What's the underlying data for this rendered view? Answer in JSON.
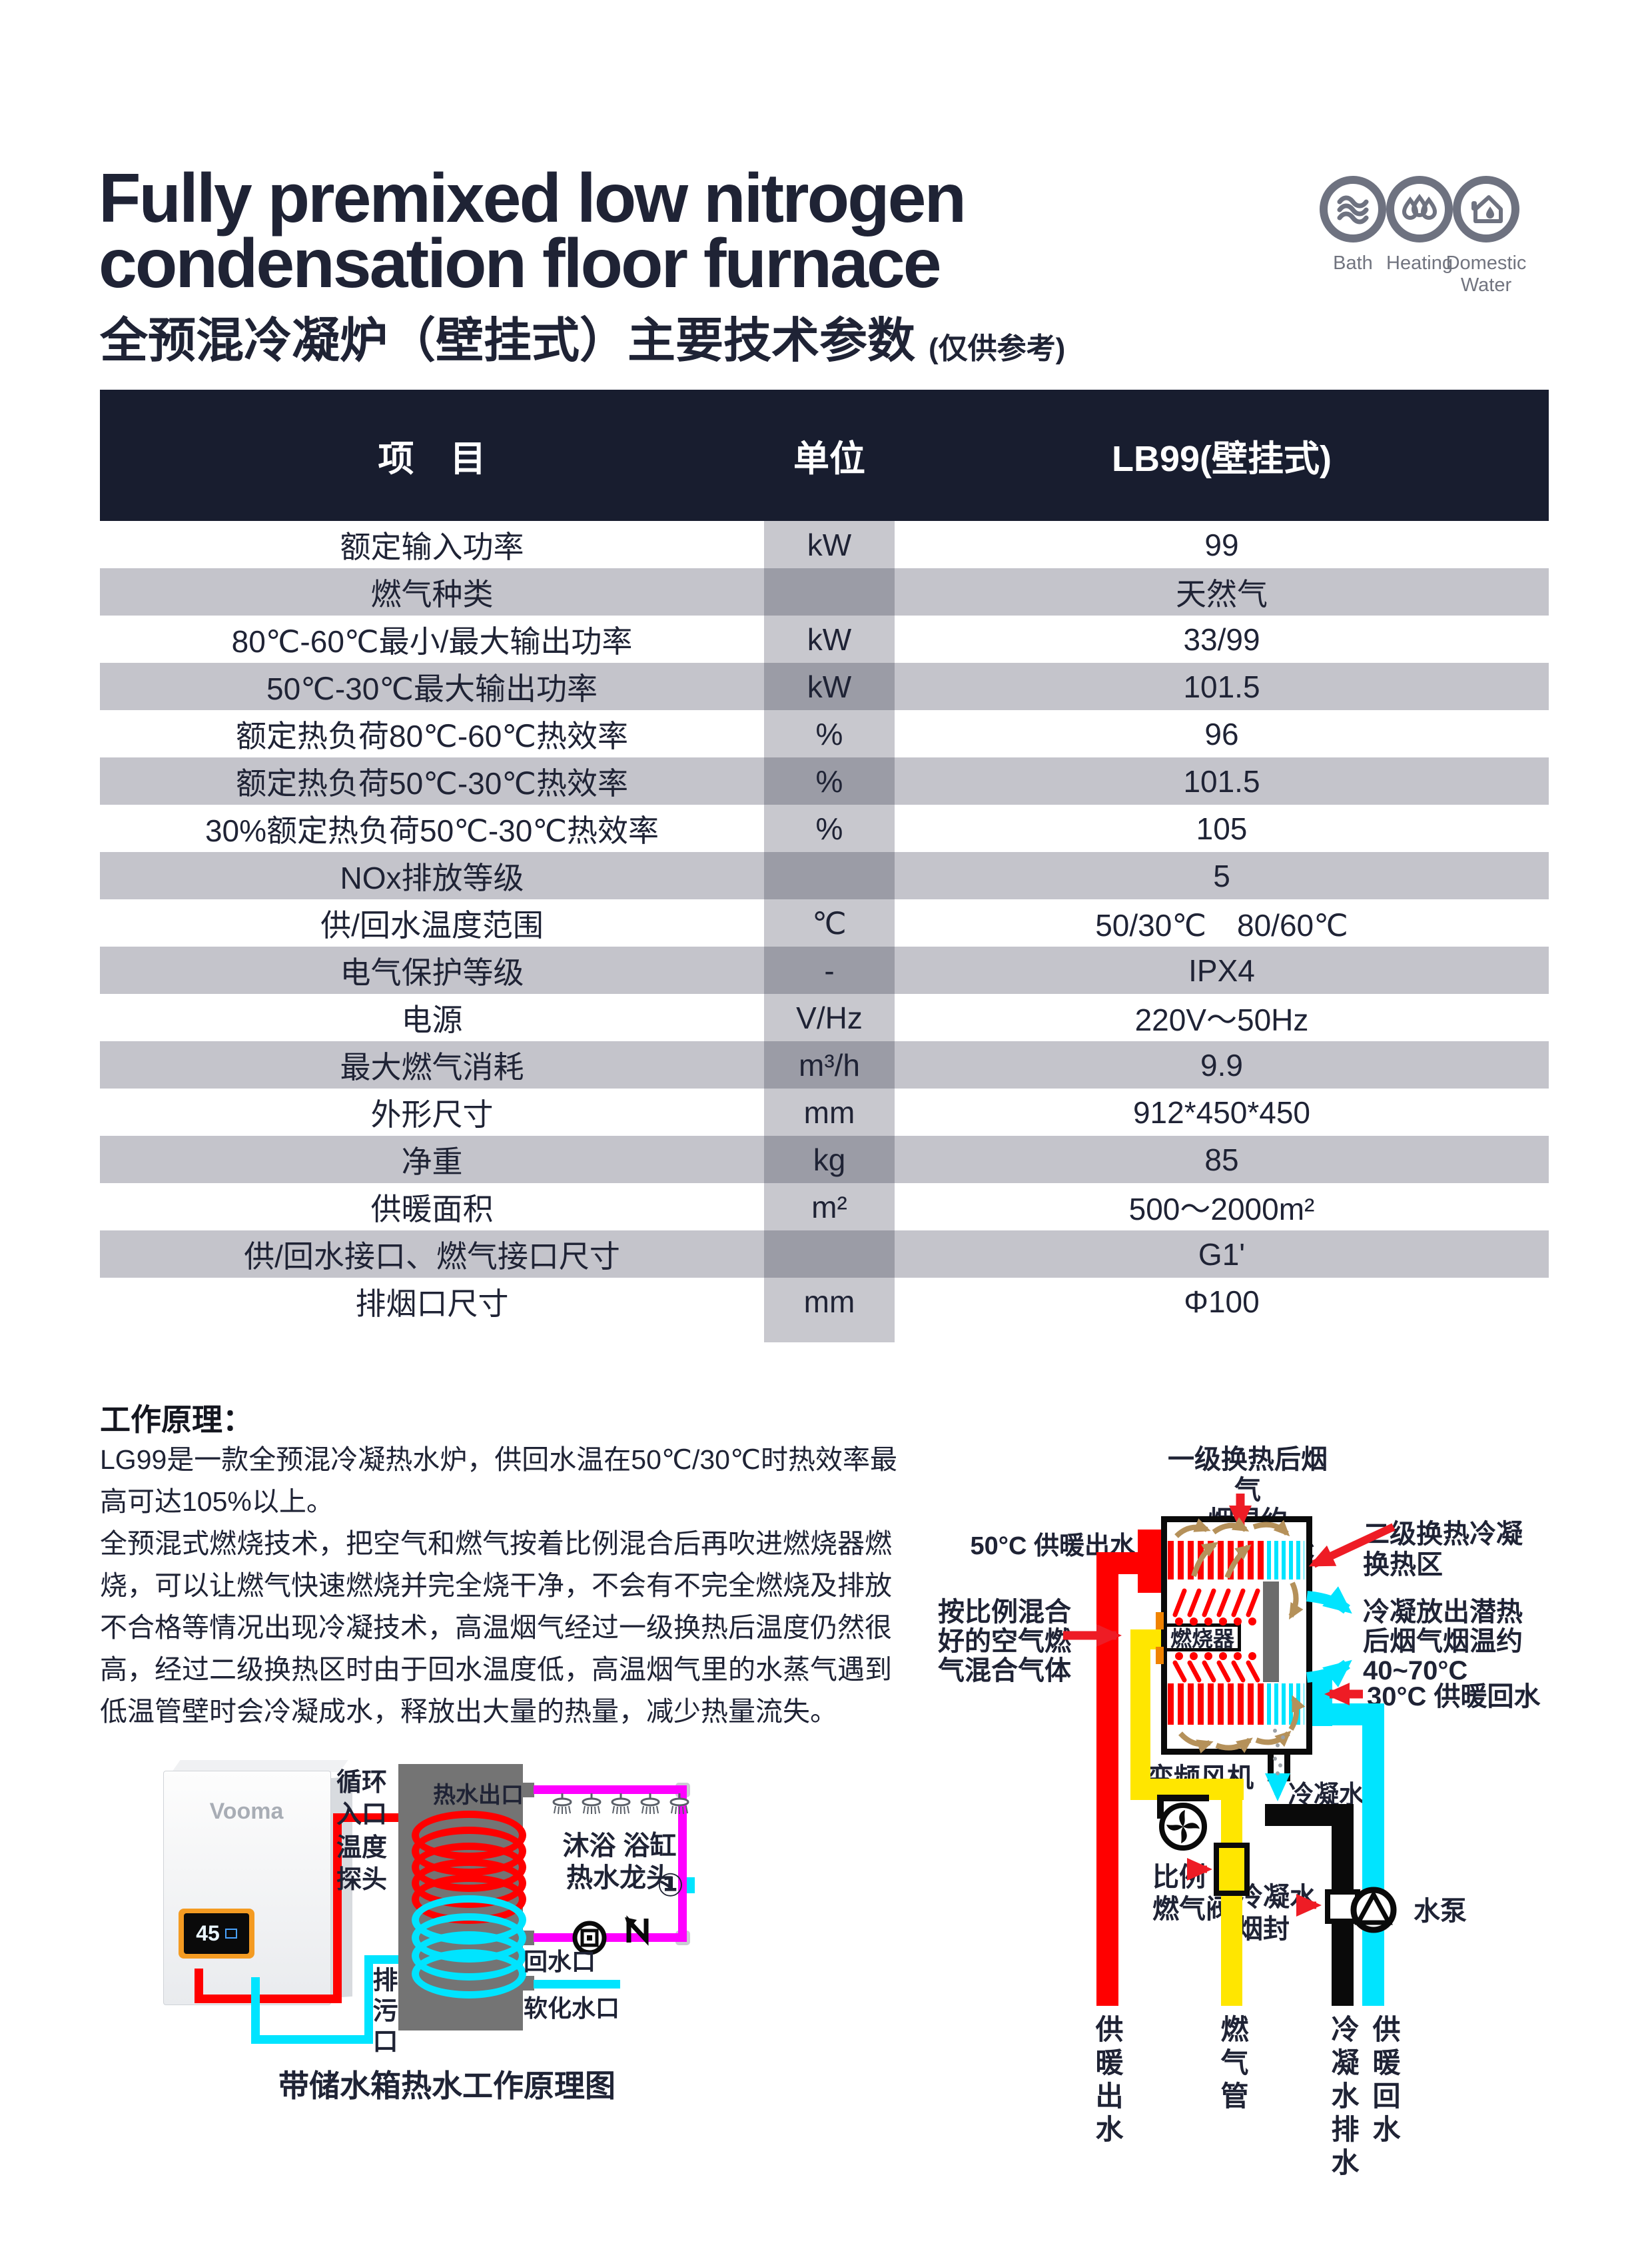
{
  "header": {
    "title_en_line1": "Fully premixed low nitrogen",
    "title_en_line2": "condensation floor furnace",
    "title_zh": "全预混冷凝炉（壁挂式）主要技术参数",
    "title_note": "(仅供参考)",
    "badges": [
      {
        "icon": "waves-icon",
        "label": "Bath"
      },
      {
        "icon": "drops-icon",
        "label": "Heating"
      },
      {
        "icon": "house-water-icon",
        "label_line1": "Domestic",
        "label_line2": "Water"
      }
    ]
  },
  "spec_table": {
    "columns": [
      "项　目",
      "单位",
      "LB99(壁挂式)"
    ],
    "rows": [
      {
        "item": "额定输入功率",
        "unit": "kW",
        "value": "99"
      },
      {
        "item": "燃气种类",
        "unit": "",
        "value": "天然气"
      },
      {
        "item": "80℃-60℃最小/最大输出功率",
        "unit": "kW",
        "value": "33/99"
      },
      {
        "item": "50℃-30℃最大输出功率",
        "unit": "kW",
        "value": "101.5"
      },
      {
        "item": "额定热负荷80℃-60℃热效率",
        "unit": "%",
        "value": "96"
      },
      {
        "item": "额定热负荷50℃-30℃热效率",
        "unit": "%",
        "value": "101.5"
      },
      {
        "item": "30%额定热负荷50℃-30℃热效率",
        "unit": "%",
        "value": "105"
      },
      {
        "item": "NOx排放等级",
        "unit": "",
        "value": "5"
      },
      {
        "item": "供/回水温度范围",
        "unit": "℃",
        "value": "50/30℃　80/60℃"
      },
      {
        "item": "电气保护等级",
        "unit": "-",
        "value": "IPX4"
      },
      {
        "item": "电源",
        "unit": "V/Hz",
        "value": "220V～50Hz"
      },
      {
        "item": "最大燃气消耗",
        "unit": "m³/h",
        "value": "9.9"
      },
      {
        "item": "外形尺寸",
        "unit": "mm",
        "value": "912*450*450"
      },
      {
        "item": "净重",
        "unit": "kg",
        "value": "85"
      },
      {
        "item": "供暖面积",
        "unit": "m²",
        "value": "500～2000m²"
      },
      {
        "item": "供/回水接口、燃气接口尺寸",
        "unit": "",
        "value": "G1'"
      },
      {
        "item": "排烟口尺寸",
        "unit": "mm",
        "value": "Φ100"
      }
    ]
  },
  "principle": {
    "heading": "工作原理：",
    "para1": "LG99是一款全预混冷凝热水炉，供回水温在50℃/30℃时热效率最高可达105%以上。",
    "para2": "全预混式燃烧技术，把空气和燃气按着比例混合后再吹进燃烧器燃烧，可以让燃气快速燃烧并完全烧干净，不会有不完全燃烧及排放不合格等情况出现冷凝技术，高温烟气经过一级换热后温度仍然很高，经过二级换热区时由于回水温度低，高温烟气里的水蒸气遇到低温管壁时会冷凝成水，释放出大量的热量，减少热量流失。"
  },
  "tank_diagram": {
    "caption": "带储水箱热水工作原理图",
    "brand": "Vooma",
    "display_value": "45",
    "labels": {
      "circulation_l1": "循环",
      "circulation_l2": "入口",
      "hot_water_outlet": "热水出口",
      "temp_probe_l1": "温度",
      "temp_probe_l2": "探头",
      "shower_l1": "沐浴 浴缸",
      "shower_l2": "热水龙头",
      "one_mark": "①",
      "return_port": "回水口",
      "drain_port": "排污口",
      "soft_water_port": "软化水口"
    }
  },
  "furnace_diagram": {
    "labels": {
      "primary_flue_l1": "一级换热后烟气",
      "primary_flue_l2": "烟温约150~180°C",
      "secondary_l1": "二级换热冷凝",
      "secondary_l2": "换热区",
      "outflow_50": "50°C 供暖出水",
      "mix_l1": "按比例混合",
      "mix_l2": "好的空气燃",
      "mix_l3": "气混合气体",
      "burner": "燃烧器",
      "latent_l1": "冷凝放出潜热",
      "latent_l2": "后烟气烟温约",
      "latent_l3": "40~70°C",
      "return_30": "30°C 供暖回水",
      "fan": "变频风机",
      "condensate": "冷凝水",
      "gas_valve_l1": "比例",
      "gas_valve_l2": "燃气阀",
      "smoke_seal_l1": "冷凝水",
      "smoke_seal_l2": "烟封",
      "pump": "水泵",
      "pipe_supply": "供暖出水",
      "pipe_gas": "燃气管",
      "pipe_condensate": "冷凝水排水",
      "pipe_return": "供暖回水"
    }
  },
  "colors": {
    "navy": "#1f2335",
    "header_bg": "#181d2f",
    "row_gray": "#c4c4cb",
    "unit_light": "#c8c8ce",
    "unit_dark": "#9b9ca6",
    "red": "#ff0000",
    "cyan": "#00e4ff",
    "yellow": "#ffe600",
    "magenta": "#ff00ff",
    "tan": "#b5915a",
    "icon_gray": "#6e7280",
    "tank_gray": "#747474",
    "panel_orange": "#f49b22"
  }
}
